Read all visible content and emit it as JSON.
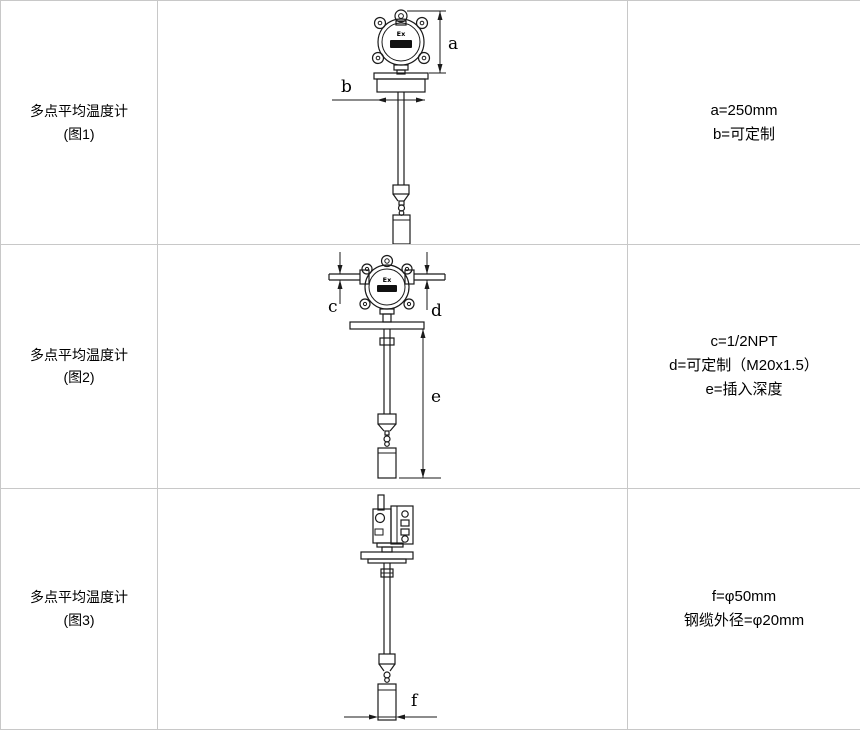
{
  "colors": {
    "table_border": "#c8c8c8",
    "diagram_line": "#1a1a1a",
    "text": "#000000",
    "background": "#ffffff"
  },
  "rows": [
    {
      "label": "多点平均温度计",
      "sub": "(图1)",
      "specs": [
        "a=250mm",
        "b=可定制"
      ]
    },
    {
      "label": "多点平均温度计",
      "sub": "(图2)",
      "specs": [
        "c=1/2NPT",
        "d=可定制（M20x1.5）",
        "e=插入深度"
      ]
    },
    {
      "label": "多点平均温度计",
      "sub": "(图3)",
      "specs": [
        "f=φ50mm",
        "钢缆外径=φ20mm"
      ]
    }
  ],
  "diagram_labels": {
    "ex": "Ex",
    "a": "a",
    "b": "b",
    "c": "c",
    "d": "d",
    "e": "e",
    "f": "f"
  }
}
